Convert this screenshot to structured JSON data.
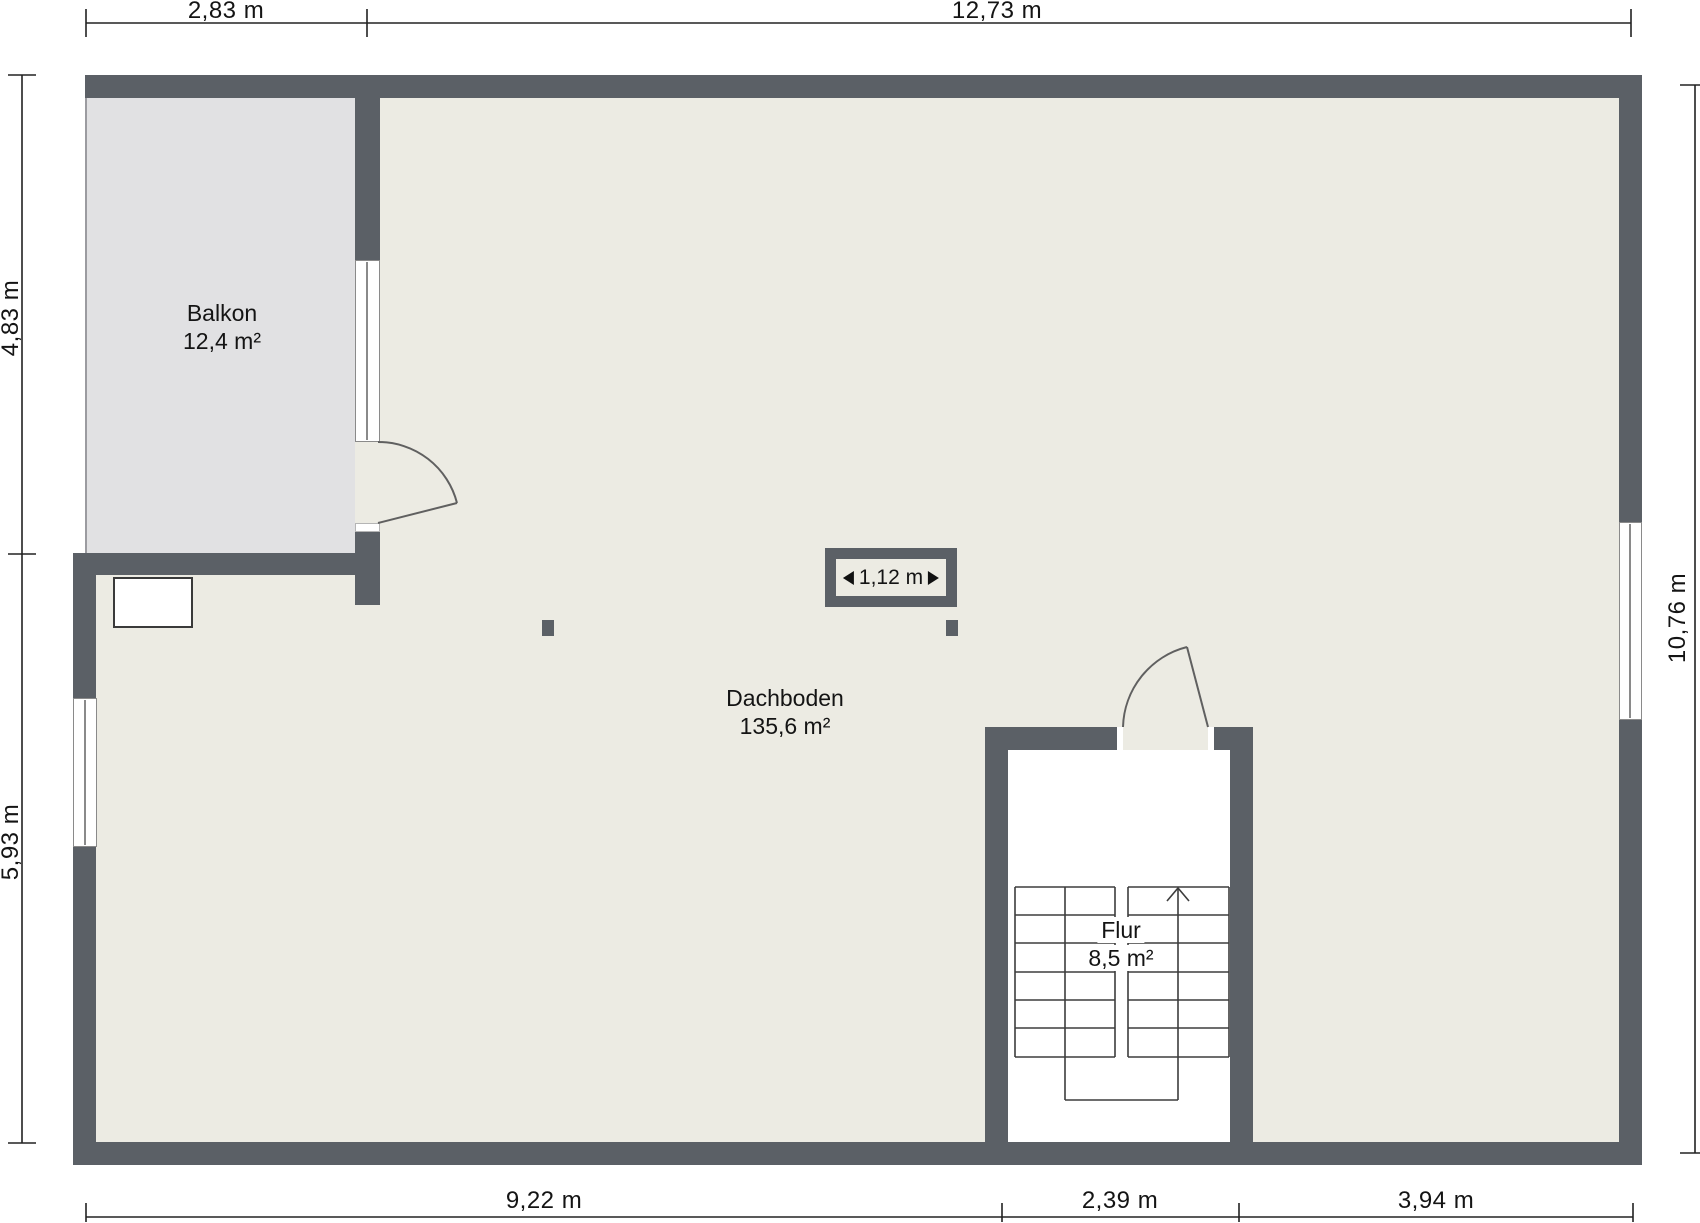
{
  "rooms": [
    {
      "name": "Balkon",
      "area": "12,4 m²"
    },
    {
      "name": "Dachboden",
      "area": "135,6 m²"
    },
    {
      "name": "Flur",
      "area": "8,5 m²"
    }
  ],
  "dimensions": {
    "top": [
      "2,83 m",
      "12,73 m"
    ],
    "left": [
      "4,83 m",
      "5,93 m"
    ],
    "right": [
      "10,76 m"
    ],
    "bottom": [
      "9,22 m",
      "2,39 m",
      "3,94 m"
    ]
  },
  "annotations": {
    "chimney_width": "1,12 m"
  },
  "colors": {
    "wall": "#5b6066",
    "floor": "#ecebe3",
    "balcony": "#e1e1e3",
    "line": "#222222",
    "stair": "#3d3d3d",
    "door": "#606060",
    "winframe": "#8a8a8a",
    "text": "#141414"
  }
}
